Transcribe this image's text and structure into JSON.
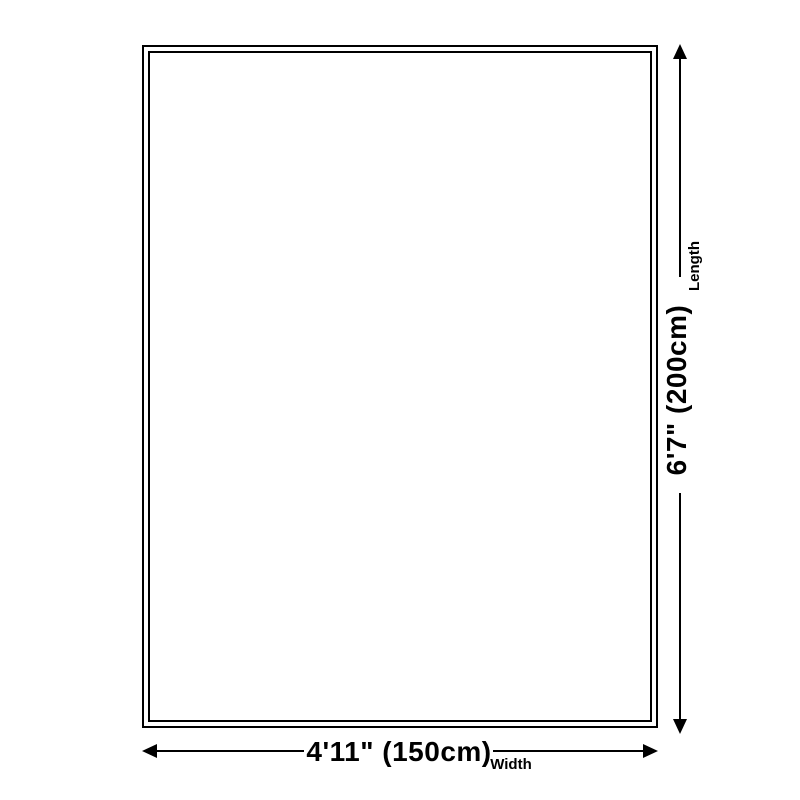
{
  "page": {
    "background_color": "#ffffff",
    "line_color": "#000000",
    "text_color": "#000000"
  },
  "diagram": {
    "name": "rug-size-diagram",
    "icons": [
      "arrow-up-icon",
      "arrow-down-icon",
      "arrow-left-icon",
      "arrow-right-icon"
    ],
    "length": {
      "value": "6'7\" (200cm)",
      "label": "Length"
    },
    "width": {
      "value": "4'11\" (150cm)",
      "label": "Width"
    }
  }
}
